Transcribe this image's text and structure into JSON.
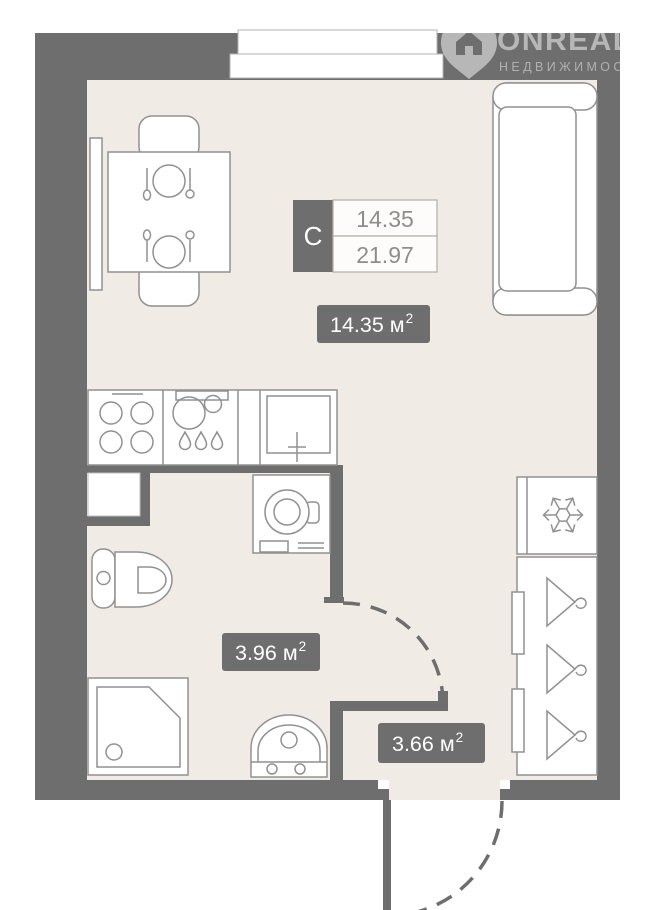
{
  "watermark": {
    "brand": "ONREALT",
    "tagline": "НЕДВИЖИМОСТЬ",
    "icon": "house-pin"
  },
  "unit_card": {
    "type_label": "С",
    "living_area": "14.35",
    "total_area": "21.97"
  },
  "area_labels": {
    "living": {
      "text": "14.35 м",
      "sup": "2"
    },
    "bathroom": {
      "text": "3.96 м",
      "sup": "2"
    },
    "hallway": {
      "text": "3.66 м",
      "sup": "2"
    }
  },
  "icons": [
    "snowflake-icon",
    "hanger-icon",
    "house-pin-icon",
    "burner-icon",
    "water-drop-icon"
  ],
  "colors": {
    "wall": "#6e6e6e",
    "floor": "#f0ebe5",
    "furniture_stroke": "#919191",
    "label_bg": "#6e6e6e",
    "label_text": "#ffffff",
    "value_text": "#8f8d8a",
    "cell_border": "#b3ada7",
    "background": "#ffffff"
  }
}
